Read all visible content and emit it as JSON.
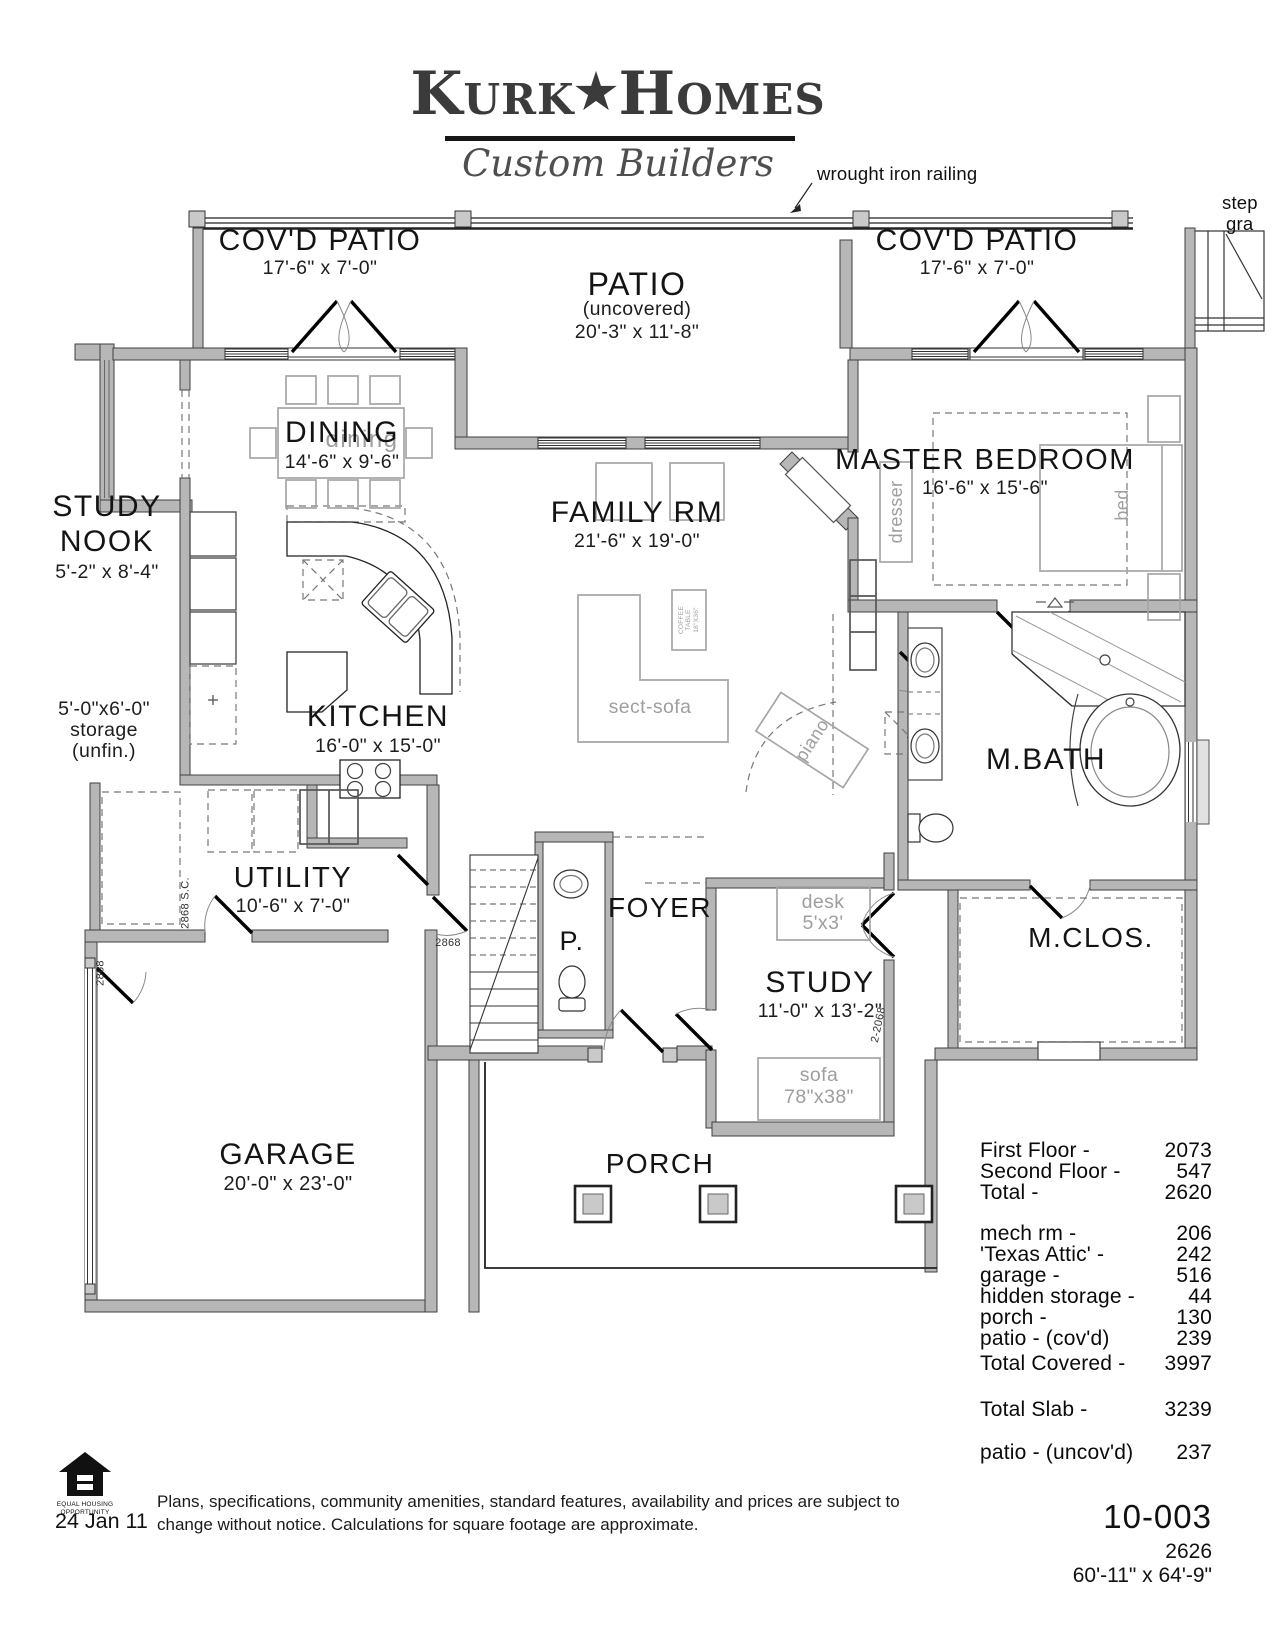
{
  "logo": {
    "word1": "Kurk",
    "star": "★",
    "word2": "Homes",
    "subtitle": "Custom Builders"
  },
  "annotations": {
    "railing": "wrought iron railing",
    "steps_line1": "step",
    "steps_line2": "gra"
  },
  "rooms": {
    "covd_patio_left": {
      "name": "COV'D PATIO",
      "dims": "17'-6\" x 7'-0\""
    },
    "patio": {
      "name": "PATIO",
      "sub": "(uncovered)",
      "dims": "20'-3\" x 11'-8\""
    },
    "covd_patio_right": {
      "name": "COV'D PATIO",
      "dims": "17'-6\" x 7'-0\""
    },
    "dining": {
      "name": "DINING",
      "dims": "14'-6\" x 9'-6\""
    },
    "study_nook": {
      "line1": "STUDY",
      "line2": "NOOK",
      "dims": "5'-2\" x 8'-4\""
    },
    "storage": {
      "line1": "5'-0\"x6'-0\"",
      "line2": "storage",
      "line3": "(unfin.)"
    },
    "family": {
      "name": "FAMILY RM",
      "dims": "21'-6\" x 19'-0\""
    },
    "kitchen": {
      "name": "KITCHEN",
      "dims": "16'-0\" x 15'-0\""
    },
    "master": {
      "name": "MASTER BEDROOM",
      "dims": "16'-6\" x 15'-6\""
    },
    "mbath": {
      "name": "M.BATH"
    },
    "utility": {
      "name": "UTILITY",
      "dims": "10'-6\" x 7'-0\""
    },
    "powder": {
      "name": "P."
    },
    "foyer": {
      "name": "FOYER"
    },
    "study": {
      "name": "STUDY",
      "dims": "11'-0\" x 13'-2\""
    },
    "mclos": {
      "name": "M.CLOS."
    },
    "garage": {
      "name": "GARAGE",
      "dims": "20'-0\" x 23'-0\""
    },
    "porch": {
      "name": "PORCH"
    }
  },
  "furniture": {
    "dining_ghost": "dining",
    "dresser": "dresser",
    "bed": "bed",
    "sect_sofa": "sect-sofa",
    "coffee_table_lines": [
      "COFFEE",
      "TABLE",
      "18\"X36\""
    ],
    "piano": "piano",
    "desk": {
      "name": "desk",
      "dims": "5'x3'"
    },
    "sofa": {
      "name": "sofa",
      "dims": "78\"x38\""
    }
  },
  "door_tags": {
    "utility_sc": "2868 S.C.",
    "utility": "2868",
    "garage": "2868",
    "study": "2-2068"
  },
  "area_table": {
    "floors": [
      {
        "label": "First Floor -",
        "value": "2073"
      },
      {
        "label": "Second Floor -",
        "value": "547"
      },
      {
        "label": "Total -",
        "value": "2620"
      }
    ],
    "spaces": [
      {
        "label": "mech rm -",
        "value": "206"
      },
      {
        "label": "'Texas Attic' -",
        "value": "242"
      },
      {
        "label": "garage -",
        "value": "516"
      },
      {
        "label": "hidden storage -",
        "value": "44"
      },
      {
        "label": "porch -",
        "value": "130"
      },
      {
        "label": "patio - (cov'd)",
        "value": "239"
      },
      {
        "label": "Total Covered -",
        "value": "3997"
      }
    ],
    "slab": {
      "label": "Total Slab -",
      "value": "3239"
    },
    "uncovered": {
      "label": "patio - (uncov'd)",
      "value": "237"
    }
  },
  "footer": {
    "plan_number": "10-003",
    "sqft": "2626",
    "overall_dims": "60'-11\" x 64'-9\"",
    "date": "24 Jan 11",
    "disclaimer_line1": "Plans, specifications, community amenities, standard features, availability and prices are subject to",
    "disclaimer_line2": "change without notice. Calculations for square footage are approximate.",
    "eho_caption_line1": "EQUAL HOUSING",
    "eho_caption_line2": "OPPORTUNITY"
  }
}
